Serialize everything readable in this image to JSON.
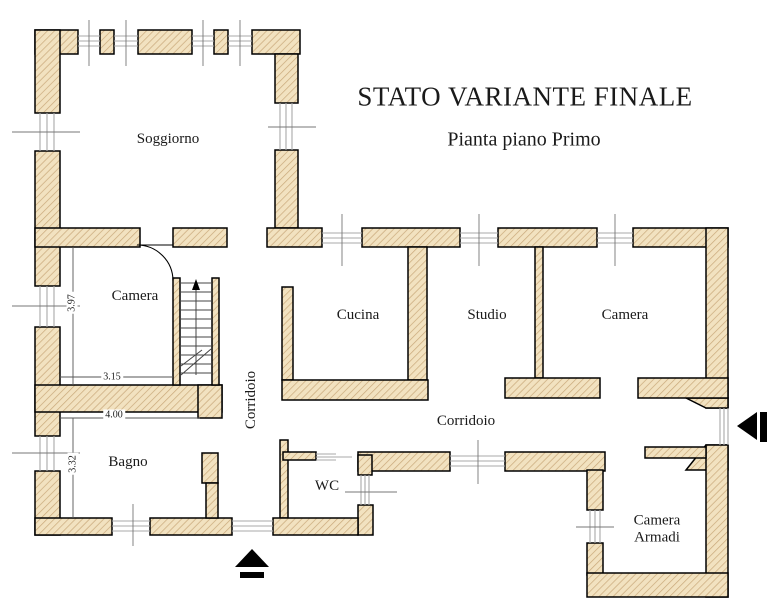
{
  "title": {
    "main": "STATO VARIANTE FINALE",
    "subtitle": "Pianta piano Primo"
  },
  "rooms": {
    "soggiorno": "Soggiorno",
    "camera_nw": "Camera",
    "cucina": "Cucina",
    "studio": "Studio",
    "camera_e": "Camera",
    "corridoio_vertical": "Corridoio",
    "corridoio_horizontal": "Corridoio",
    "bagno": "Bagno",
    "wc": "WC",
    "camera_armadi_line1": "Camera",
    "camera_armadi_line2": "Armadi"
  },
  "dimensions": {
    "camera_height_m": "3.97",
    "camera_width_m": "3.15",
    "bagno_width_m": "4.00",
    "bagno_height_m": "3.32"
  },
  "icons": {
    "stairs_direction_arrow": "up-arrow",
    "main_entrance_arrow": "up-arrow-with-bar",
    "side_entrance_arrow": "left-arrow-with-bar"
  },
  "colors": {
    "wall_fill": "#f2e2c0",
    "wall_hatch": "#c9a87a",
    "wall_outline": "#000000",
    "glazing": "#a8a8a8",
    "tick": "#777777",
    "dimension": "#555555",
    "text": "#1a1a1a",
    "arrow": "#000000",
    "background": "#ffffff"
  }
}
